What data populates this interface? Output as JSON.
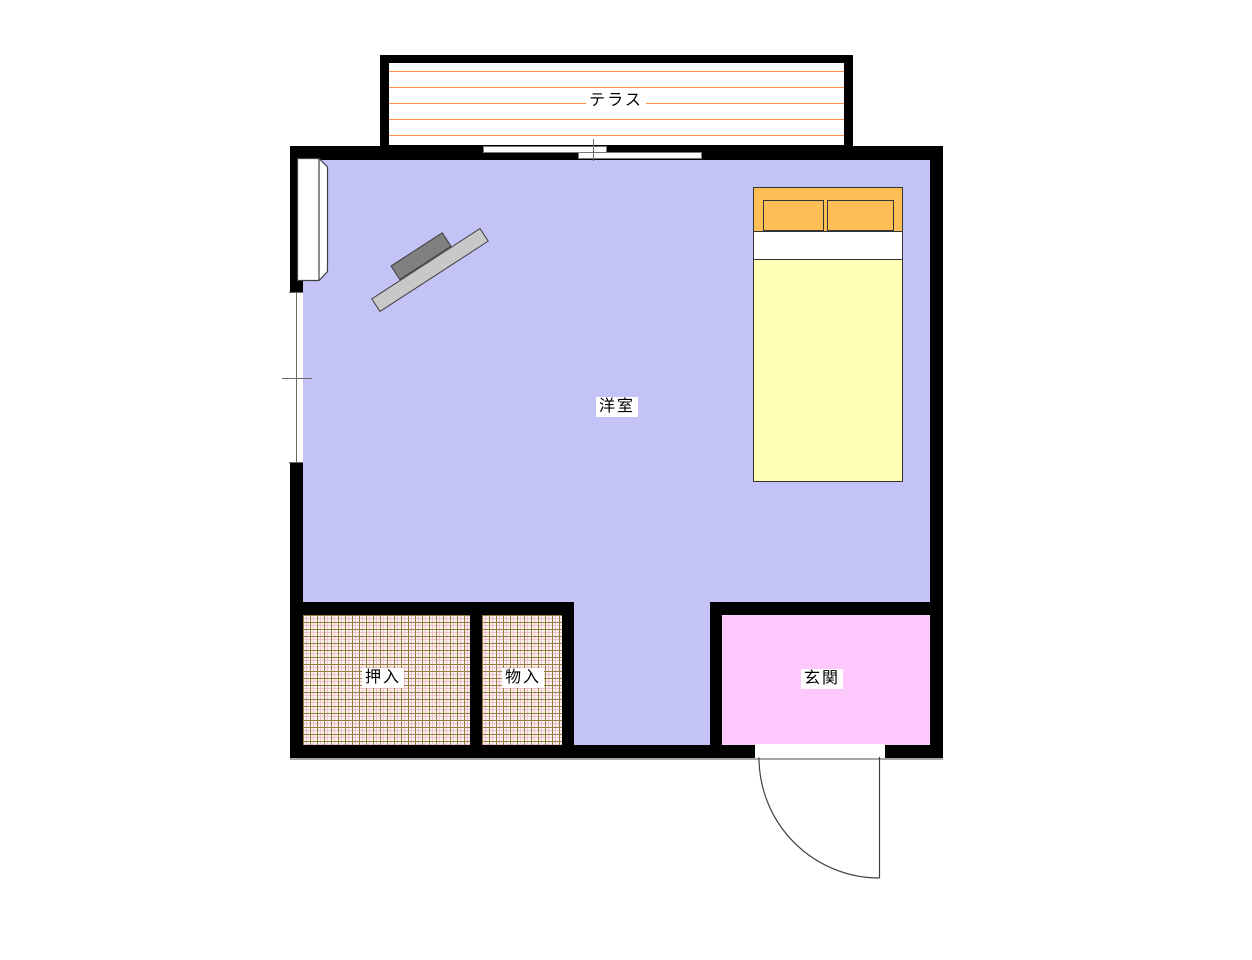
{
  "floorplan": {
    "rooms": {
      "terrace": {
        "label": "テラス"
      },
      "western_room": {
        "label": "洋室"
      },
      "closet": {
        "label": "押入"
      },
      "storage": {
        "label": "物入"
      },
      "entrance": {
        "label": "玄関"
      }
    },
    "colors": {
      "page_bg": "#ffffff",
      "wall": "#000000",
      "room_floor": "#c3c3f8",
      "entrance_floor": "#fdc8fb",
      "terrace_floor": "#ffffff",
      "terrace_line": "#ff8c45",
      "closet_floor": "#fdf0f3",
      "closet_grid": "#8f8040",
      "closet_grid_light": "#f0c0cc",
      "bed_mattress": "#ffffb5",
      "bed_pillow": "#fcbe55",
      "bed_sheet": "#ffffff",
      "furniture_light": "#c8c8c8",
      "furniture_dark": "#808080",
      "line_color": "#404040"
    }
  }
}
